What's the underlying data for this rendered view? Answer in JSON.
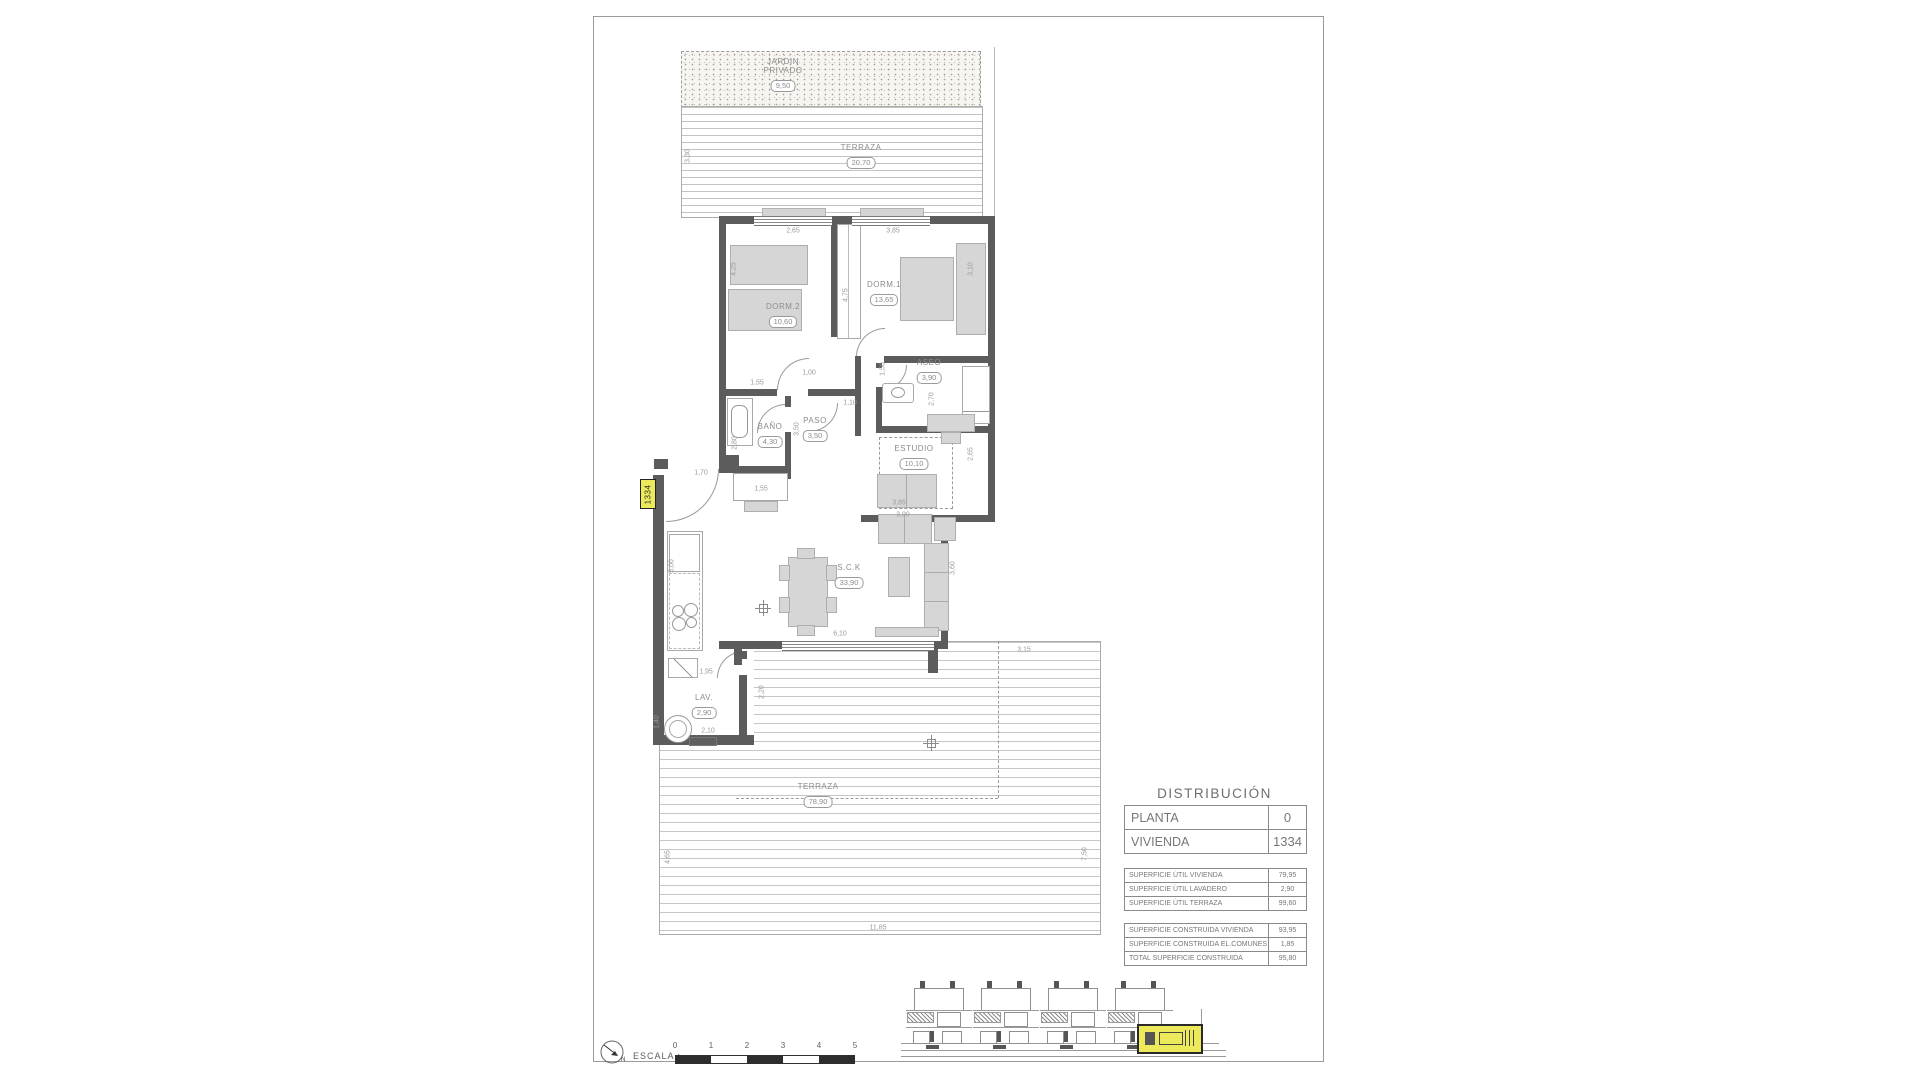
{
  "plan": {
    "unit_tag": "1334",
    "rooms": [
      {
        "name": "JARDIN\nPRIVADO",
        "value": "9,50",
        "x": 189,
        "y": 40
      },
      {
        "name": "TERRAZA",
        "value": "20,70",
        "x": 267,
        "y": 126
      },
      {
        "name": "DORM.2",
        "value": "10,60",
        "x": 189,
        "y": 285
      },
      {
        "name": "DORM.1",
        "value": "13,65",
        "x": 290,
        "y": 263
      },
      {
        "name": "ASEO",
        "value": "3,90",
        "x": 335,
        "y": 341
      },
      {
        "name": "BAÑO",
        "value": "4,30",
        "x": 176,
        "y": 405
      },
      {
        "name": "PASO",
        "value": "3,50",
        "x": 221,
        "y": 399
      },
      {
        "name": "ESTUDIO",
        "value": "10,10",
        "x": 320,
        "y": 427
      },
      {
        "name": "S.C.K",
        "value": "33,90",
        "x": 255,
        "y": 546
      },
      {
        "name": "LAV.",
        "value": "2,90",
        "x": 110,
        "y": 676
      },
      {
        "name": "TERRAZA",
        "value": "78,90",
        "x": 224,
        "y": 765
      }
    ],
    "dims": [
      {
        "t": "3,30",
        "x": 94,
        "y": 139,
        "r": 1
      },
      {
        "t": "2,65",
        "x": 199,
        "y": 214,
        "r": 0
      },
      {
        "t": "3,85",
        "x": 299,
        "y": 214,
        "r": 0
      },
      {
        "t": "4,25",
        "x": 140,
        "y": 252,
        "r": 1
      },
      {
        "t": "4,75",
        "x": 252,
        "y": 278,
        "r": 1
      },
      {
        "t": "3,10",
        "x": 377,
        "y": 252,
        "r": 1
      },
      {
        "t": "1,55",
        "x": 163,
        "y": 366,
        "r": 0
      },
      {
        "t": "1,00",
        "x": 215,
        "y": 356,
        "r": 0
      },
      {
        "t": "1,50",
        "x": 289,
        "y": 352,
        "r": 1
      },
      {
        "t": "2,70",
        "x": 338,
        "y": 382,
        "r": 1
      },
      {
        "t": "1,10",
        "x": 256,
        "y": 386,
        "r": 0
      },
      {
        "t": "3,50",
        "x": 203,
        "y": 412,
        "r": 1
      },
      {
        "t": "2,80",
        "x": 141,
        "y": 426,
        "r": 1
      },
      {
        "t": "1,55",
        "x": 167,
        "y": 472,
        "r": 0
      },
      {
        "t": "2,65",
        "x": 377,
        "y": 437,
        "r": 1
      },
      {
        "t": "3,85",
        "x": 305,
        "y": 486,
        "r": 0
      },
      {
        "t": "3,90",
        "x": 309,
        "y": 498,
        "r": 0
      },
      {
        "t": "1,70",
        "x": 107,
        "y": 456,
        "r": 0
      },
      {
        "t": "5,00",
        "x": 78,
        "y": 549,
        "r": 1
      },
      {
        "t": "6,10",
        "x": 246,
        "y": 617,
        "r": 0
      },
      {
        "t": "3,60",
        "x": 359,
        "y": 551,
        "r": 1
      },
      {
        "t": "1,95",
        "x": 112,
        "y": 655,
        "r": 0
      },
      {
        "t": "2,10",
        "x": 114,
        "y": 714,
        "r": 0
      },
      {
        "t": "2,20",
        "x": 168,
        "y": 675,
        "r": 1
      },
      {
        "t": "1,40",
        "x": 63,
        "y": 705,
        "r": 1
      },
      {
        "t": "3,15",
        "x": 430,
        "y": 633,
        "r": 0
      },
      {
        "t": "4,65",
        "x": 74,
        "y": 840,
        "r": 1
      },
      {
        "t": "7,50",
        "x": 491,
        "y": 837,
        "r": 1
      },
      {
        "t": "11,85",
        "x": 284,
        "y": 911,
        "r": 0
      }
    ]
  },
  "title_block": {
    "title": "DISTRIBUCIÓN",
    "main_rows": [
      {
        "label": "PLANTA",
        "value": "0"
      },
      {
        "label": "VIVIENDA",
        "value": "1334"
      }
    ],
    "util_rows": [
      {
        "label": "SUPERFICIE ÚTIL VIVIENDA",
        "value": "79,95"
      },
      {
        "label": "SUPERFICIE ÚTIL LAVADERO",
        "value": "2,90"
      },
      {
        "label": "SUPERFICIE ÚTIL TERRAZA",
        "value": "99,60"
      }
    ],
    "built_rows": [
      {
        "label": "SUPERFICIE CONSTRUIDA VIVIENDA",
        "value": "93,95"
      },
      {
        "label": "SUPERFICIE CONSTRUIDA EL.COMUNES",
        "value": "1,85"
      },
      {
        "label": "TOTAL SUPERFICIE CONSTRUIDA",
        "value": "95,80"
      }
    ]
  },
  "scale_bar": {
    "label": "ESCALA :",
    "ticks": [
      "0",
      "1",
      "2",
      "3",
      "4",
      "5"
    ],
    "north_letter": "N"
  },
  "colors": {
    "wall": "#5c5c5c",
    "highlight_yellow": "#ece95a",
    "text_grey": "#8c8c8c"
  }
}
